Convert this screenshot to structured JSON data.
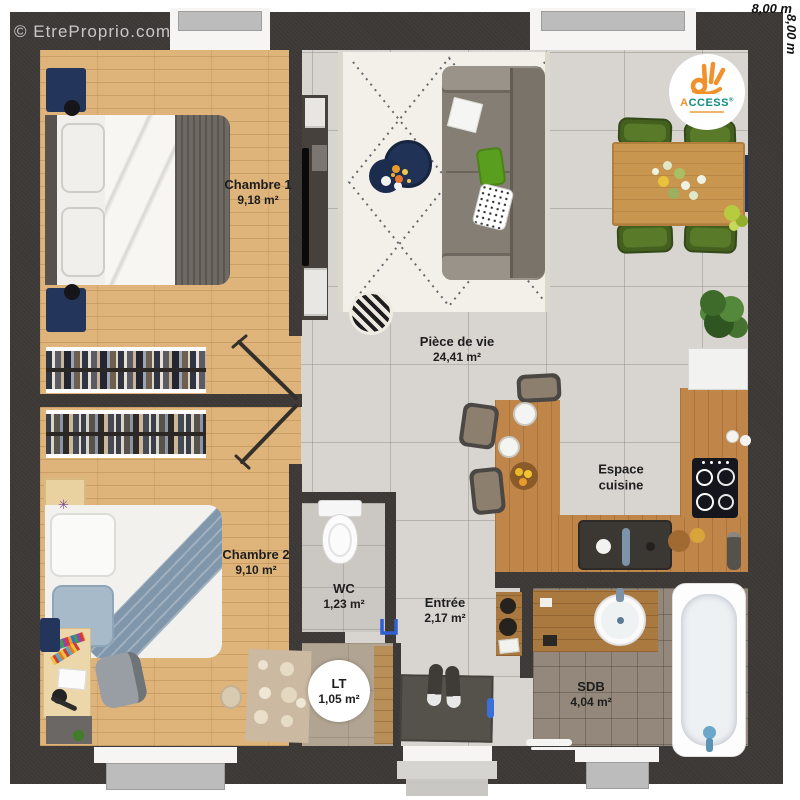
{
  "watermark": {
    "text": "© EtreProprio.com"
  },
  "dimensions": {
    "width_label": "8,00 m",
    "height_label": "8,00 m"
  },
  "logo": {
    "brand_first": "A",
    "brand_rest": "CCESS",
    "registered": "®"
  },
  "rooms": [
    {
      "name": "Chambre 1",
      "area": "9,18 m²"
    },
    {
      "name": "Chambre 2",
      "area": "9,10 m²"
    },
    {
      "name": "Pièce de vie",
      "area": "24,41 m²"
    },
    {
      "name": "Espace cuisine",
      "area": ""
    },
    {
      "name": "WC",
      "area": "1,23 m²"
    },
    {
      "name": "Entrée",
      "area": "2,17 m²"
    },
    {
      "name": "LT",
      "area": "1,05 m²"
    },
    {
      "name": "SDB",
      "area": "4,04 m²"
    }
  ],
  "colors": {
    "wall": "#3c3836",
    "wood_floor": "#deb47a",
    "tile": "#d8d5d0",
    "sdb_tile": "#93887b",
    "navy": "#24355c",
    "sofa": "#8d867d",
    "chair_green": "#44601f",
    "counter_wood": "#c08549",
    "logo_orange": "#f0912c",
    "logo_teal": "#0e8d80",
    "door_blue": "#2f5fd0"
  }
}
